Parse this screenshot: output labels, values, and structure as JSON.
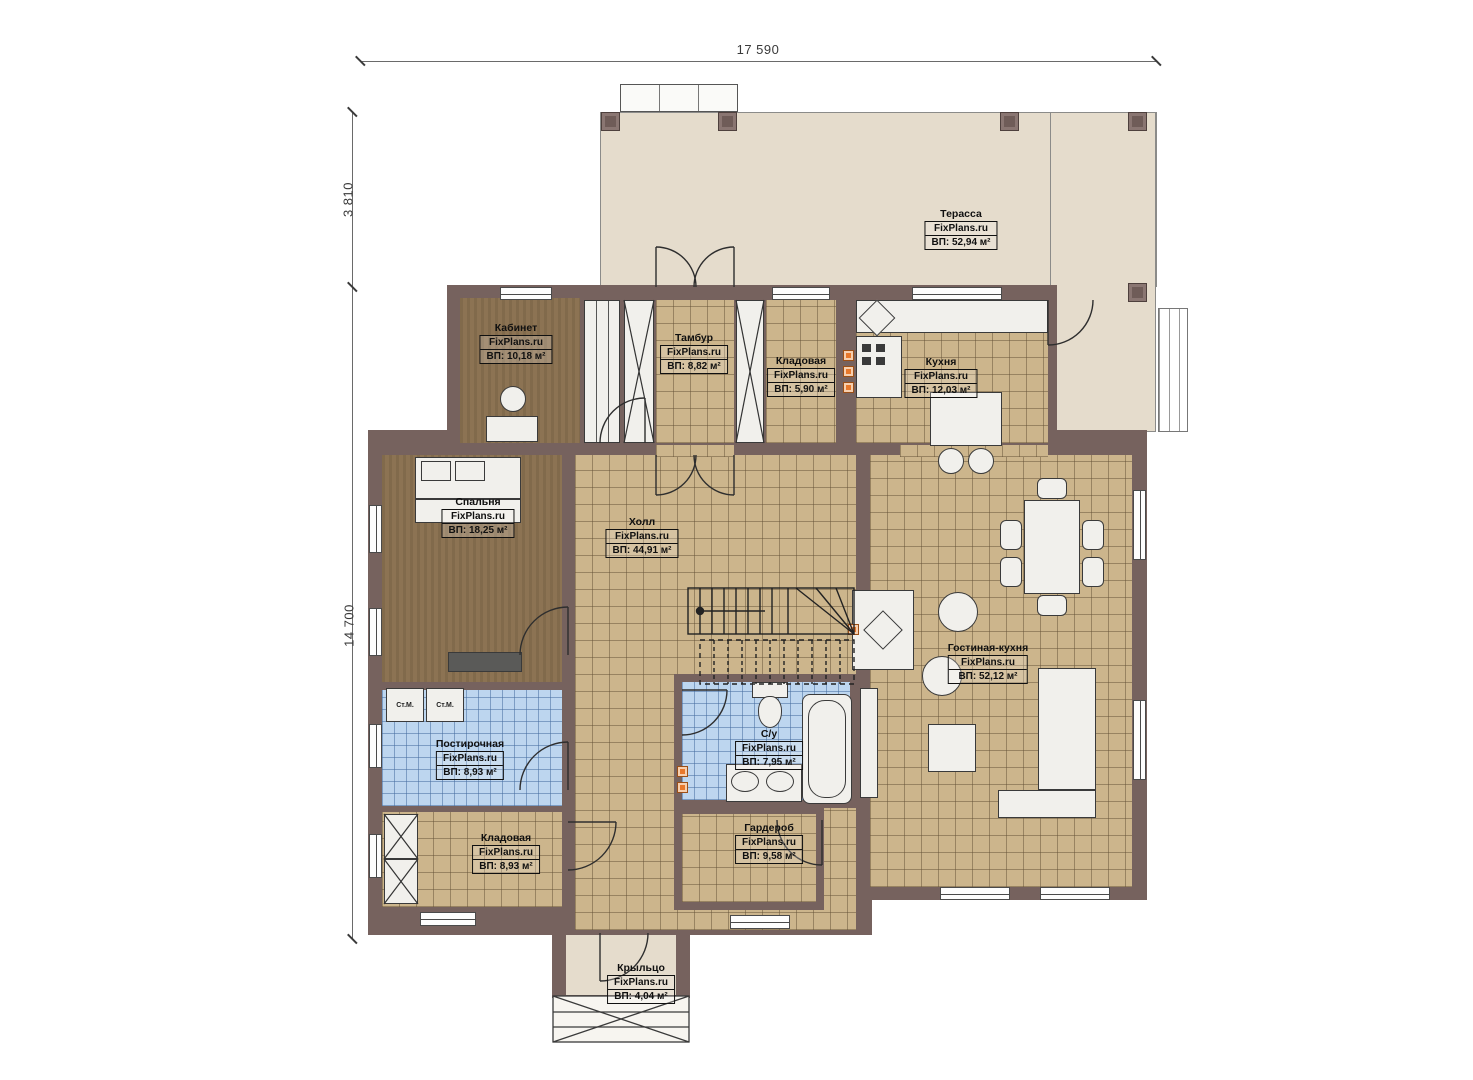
{
  "watermark": "FixPlans.ru",
  "dimensions": {
    "width_top": "17 590",
    "height_upper": "3 810",
    "height_main": "14 700"
  },
  "washer_label": "Ст.М.",
  "rooms": [
    {
      "key": "terrace",
      "name": "Терасса",
      "area": "ВП: 52,94 м²"
    },
    {
      "key": "office",
      "name": "Кабинет",
      "area": "ВП: 10,18 м²"
    },
    {
      "key": "vestibule",
      "name": "Тамбур",
      "area": "ВП: 8,82 м²"
    },
    {
      "key": "pantry-top",
      "name": "Кладовая",
      "area": "ВП: 5,90 м²"
    },
    {
      "key": "kitchen",
      "name": "Кухня",
      "area": "ВП: 12,03 м²"
    },
    {
      "key": "bedroom",
      "name": "Спальня",
      "area": "ВП: 18,25 м²"
    },
    {
      "key": "hall",
      "name": "Холл",
      "area": "ВП: 44,91 м²"
    },
    {
      "key": "living-kitchen",
      "name": "Гостиная-кухня",
      "area": "ВП: 52,12 м²"
    },
    {
      "key": "laundry",
      "name": "Постирочная",
      "area": "ВП: 8,93 м²"
    },
    {
      "key": "bathroom",
      "name": "С/у",
      "area": "ВП: 7,95 м²"
    },
    {
      "key": "pantry-bottom",
      "name": "Кладовая",
      "area": "ВП: 8,93 м²"
    },
    {
      "key": "wardrobe",
      "name": "Гардероб",
      "area": "ВП: 9,58 м²"
    },
    {
      "key": "porch",
      "name": "Крыльцо",
      "area": "ВП: 4,04 м²"
    }
  ],
  "colors": {
    "wall": "#76625e",
    "floor_tile_tan": "#ccb58c",
    "floor_wood_brown": "#8c7353",
    "floor_tile_blue": "#bdd6ef",
    "terrace_floor": "#e5dccc",
    "utility_marker_orange": "#e8782b"
  }
}
